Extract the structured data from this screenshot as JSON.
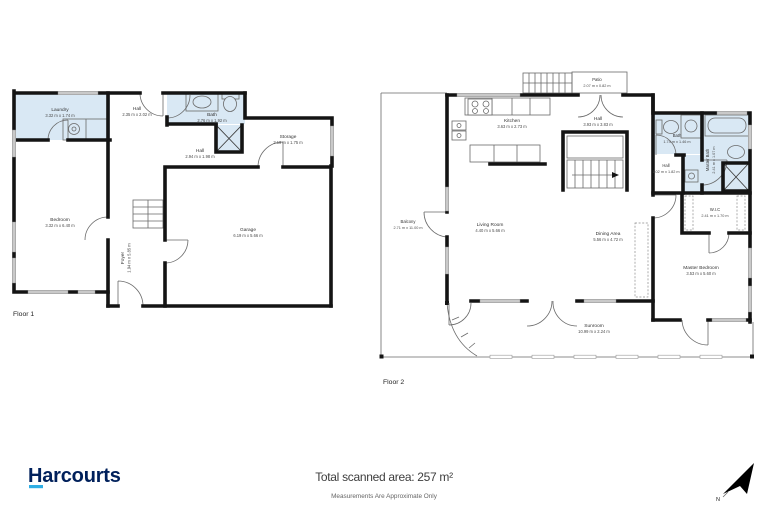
{
  "page": {
    "logo_text": "Harcourts",
    "total_area_label": "Total scanned area: 257 m²",
    "disclaimer": "Measurements Are Approximate Only",
    "north_label": "N",
    "colors": {
      "wet_area": "#d9e8f4",
      "wall": "#141414",
      "logo_navy": "#00205b",
      "logo_cyan": "#2faee4"
    }
  },
  "floor1": {
    "label": "Floor 1",
    "rooms": [
      {
        "name": "Laundry",
        "dims": "3.32 m x 1.74 m"
      },
      {
        "name": "Hall",
        "dims": "2.35 m x 2.02 m"
      },
      {
        "name": "Bath",
        "dims": "2.76 m x 1.92 m"
      },
      {
        "name": "Storage",
        "dims": "3.19 m x 1.75 m"
      },
      {
        "name": "Hall",
        "dims": "2.94 m x 1.98 m"
      },
      {
        "name": "Bedroom",
        "dims": "3.32 m x 6.40 m"
      },
      {
        "name": "Foyer",
        "dims": "1.94 m x 5.85 m"
      },
      {
        "name": "Garage",
        "dims": "6.19 m x 5.66 m"
      }
    ]
  },
  "floor2": {
    "label": "Floor 2",
    "rooms": [
      {
        "name": "Patio",
        "dims": "2.07 m x 0.82 m"
      },
      {
        "name": "Kitchen",
        "dims": "3.63 m x 2.73 m"
      },
      {
        "name": "Hall",
        "dims": "3.93 m x 3.83 m"
      },
      {
        "name": "Bath",
        "dims": "1.74 m x 1.46 m"
      },
      {
        "name": "Master Bath",
        "dims": "2.41 m x 1.07 m"
      },
      {
        "name": "Hall",
        "dims": "1.02 m x 1.82 m"
      },
      {
        "name": "W.I.C",
        "dims": "2.41 m x 1.70 m"
      },
      {
        "name": "Living Room",
        "dims": "4.40 m x 5.66 m"
      },
      {
        "name": "Dining Area",
        "dims": "5.56 m x 4.72 m"
      },
      {
        "name": "Balcony",
        "dims": "2.71 m x 11.00 m"
      },
      {
        "name": "Sunroom",
        "dims": "10.99 m x 2.24 m"
      },
      {
        "name": "Master Bedroom",
        "dims": "3.53 m x 5.60 m"
      }
    ]
  }
}
